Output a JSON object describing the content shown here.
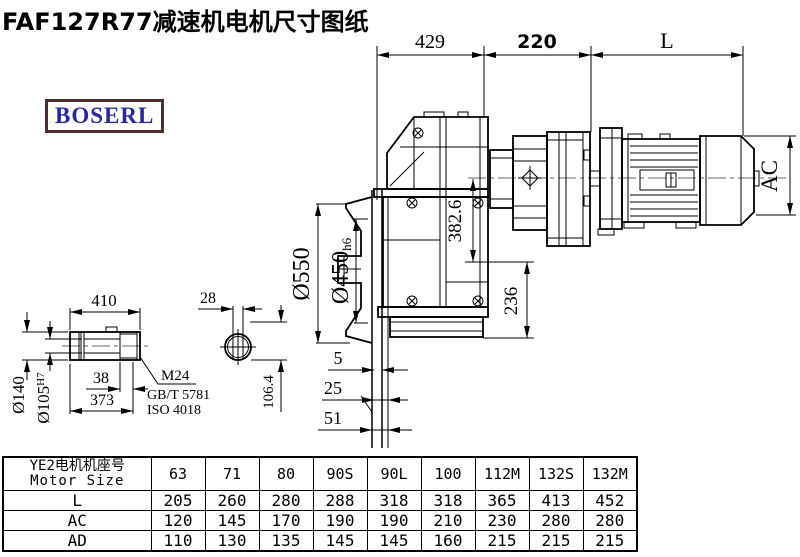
{
  "title": "FAF127R77减速机电机尺寸图纸",
  "logo": {
    "text": "BOSERL",
    "border_color": "#53292b",
    "text_color": "#2724ad"
  },
  "colors": {
    "line": "#000000",
    "centerline": "#666666",
    "background": "#ffffff"
  },
  "dims": {
    "d429": "429",
    "d220": "220",
    "dL": "L",
    "dAC": "AC",
    "d550": "Ø550",
    "d450": "Ø450",
    "d450t": "h6",
    "d382": "382.6",
    "d236": "236",
    "d5": "5",
    "d25": "25",
    "d51": "51",
    "d410": "410",
    "d28": "28",
    "d140": "Ø140",
    "d105": "Ø105",
    "d105t": "H7",
    "d38": "38",
    "d373": "373",
    "d106": "106.4",
    "thread": "M24",
    "std1": "GB/T 5781",
    "std2": "ISO 4018"
  },
  "table": {
    "header_cn": "YE2电机机座号",
    "header_en": "Motor Size",
    "columns": [
      "63",
      "71",
      "80",
      "90S",
      "90L",
      "100",
      "112M",
      "132S",
      "132M"
    ],
    "rows": [
      {
        "label": "L",
        "values": [
          "205",
          "260",
          "280",
          "288",
          "318",
          "318",
          "365",
          "413",
          "452"
        ]
      },
      {
        "label": "AC",
        "values": [
          "120",
          "145",
          "170",
          "190",
          "190",
          "210",
          "230",
          "280",
          "280"
        ]
      },
      {
        "label": "AD",
        "values": [
          "110",
          "130",
          "135",
          "145",
          "145",
          "160",
          "215",
          "215",
          "215"
        ]
      }
    ]
  }
}
